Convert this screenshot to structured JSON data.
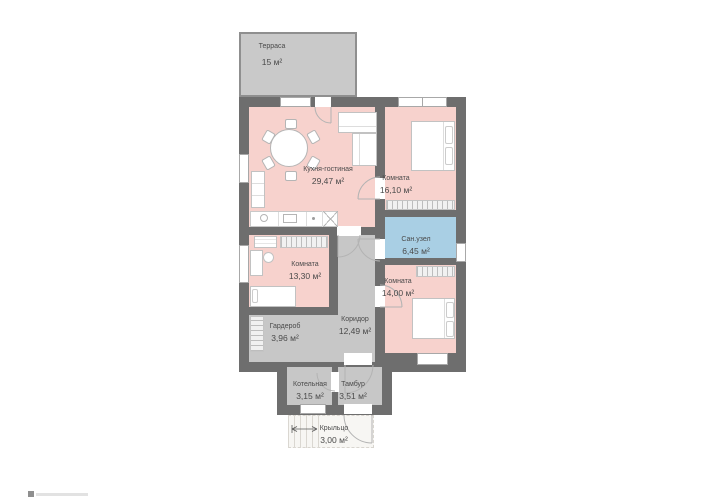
{
  "palette": {
    "wall": "#6e6e6e",
    "room-pink": "#f7d2cd",
    "room-blue": "#a9cfe4",
    "room-gray": "#c7c7c7",
    "terrace-gray": "#c9c9c9",
    "text": "#4a4a4a"
  },
  "rooms": [
    {
      "name": "Терраса",
      "area": "15 м²"
    },
    {
      "name": "Кухня-гостиная",
      "area": "29,47 м²"
    },
    {
      "name": "Комната",
      "area": "16,10 м²"
    },
    {
      "name": "Сан.узел",
      "area": "6,45 м²"
    },
    {
      "name": "Комната",
      "area": "14,00 м²"
    },
    {
      "name": "Комната",
      "area": "13,30 м²"
    },
    {
      "name": "Гардероб",
      "area": "3,96 м²"
    },
    {
      "name": "Коридор",
      "area": "12,49 м²"
    },
    {
      "name": "Котельная",
      "area": "3,15 м²"
    },
    {
      "name": "Тамбур",
      "area": "3,51 м²"
    },
    {
      "name": "Крыльцо",
      "area": "3,00 м²"
    }
  ]
}
